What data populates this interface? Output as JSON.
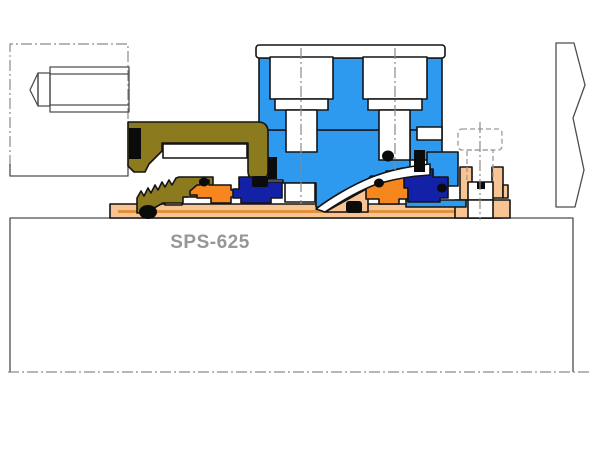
{
  "diagram": {
    "title": "SPS-625",
    "title_color": "#969696",
    "colors": {
      "blue": "#2E9AEF",
      "olive": "#8C7A1E",
      "orange": "#F6871F",
      "navy": "#1321A6",
      "peach": "#F8C493",
      "accent": "#E0913C",
      "black": "#0B0B0B",
      "white": "#FFFFFF",
      "outline_dark": "#141414",
      "outline_gray": "#4D4D4D",
      "phantom_gray": "#8A8A8A"
    },
    "parts": [
      {
        "name": "pump-housing-box",
        "color": "#FFFFFF"
      },
      {
        "name": "shaft-centerline",
        "color": "#8A8A8A"
      },
      {
        "name": "phantom-equipment-box",
        "color": "#8A8A8A"
      },
      {
        "name": "set-screw-outline",
        "color": "#4D4D4D"
      },
      {
        "name": "end-wall-break-line",
        "color": "#4D4D4D"
      },
      {
        "name": "gland-plate",
        "color": "#2E9AEF"
      },
      {
        "name": "gland-bolts",
        "color": "#FFFFFF"
      },
      {
        "name": "drive-collar",
        "color": "#8C7A1E"
      },
      {
        "name": "wave-spring",
        "color": "#8C7A1E"
      },
      {
        "name": "shaft-sleeve",
        "color": "#F8C493"
      },
      {
        "name": "collar-bolt",
        "color": "#FFFFFF"
      },
      {
        "name": "inboard-rotating-face",
        "color": "#F6871F"
      },
      {
        "name": "inboard-stationary-face",
        "color": "#1321A6"
      },
      {
        "name": "outboard-rotating-face",
        "color": "#F6871F"
      },
      {
        "name": "outboard-stationary-face",
        "color": "#1321A6"
      },
      {
        "name": "o-rings-and-set-screws",
        "color": "#0B0B0B"
      }
    ]
  }
}
